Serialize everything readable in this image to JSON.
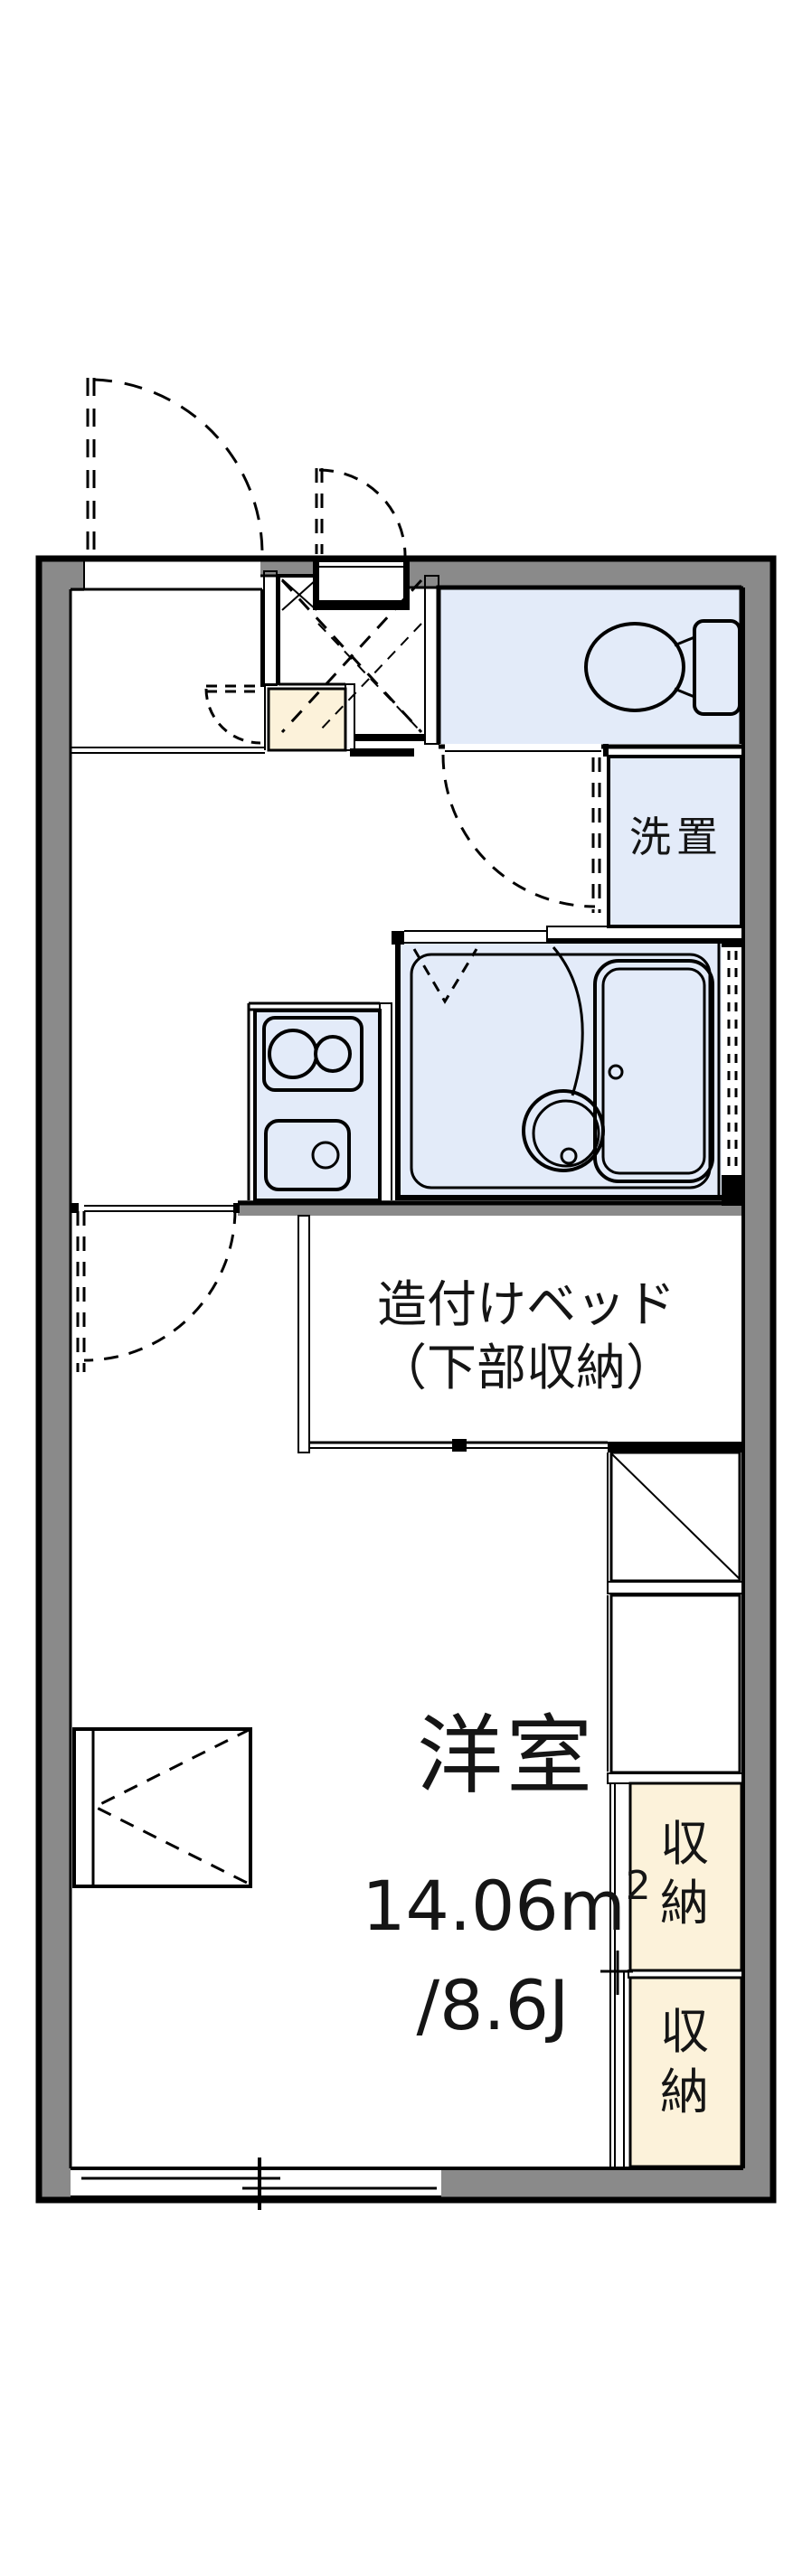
{
  "plan": {
    "colors": {
      "wall_gray": "#8a8a8a",
      "room_blue": "#e3ebf9",
      "closet_cream": "#fcf2da",
      "line_black": "#000000",
      "bg_white": "#ffffff"
    },
    "labels": {
      "laundry": "洗置",
      "bed_line1": "造付けベッド",
      "bed_line2": "（下部収納）",
      "living_name": "洋室",
      "living_area_base": "14.06m",
      "living_area_sup": "2",
      "living_tatami": "/8.6J",
      "storage_top_char1": "収",
      "storage_top_char2": "納",
      "storage_bottom_char1": "収",
      "storage_bottom_char2": "納"
    }
  }
}
